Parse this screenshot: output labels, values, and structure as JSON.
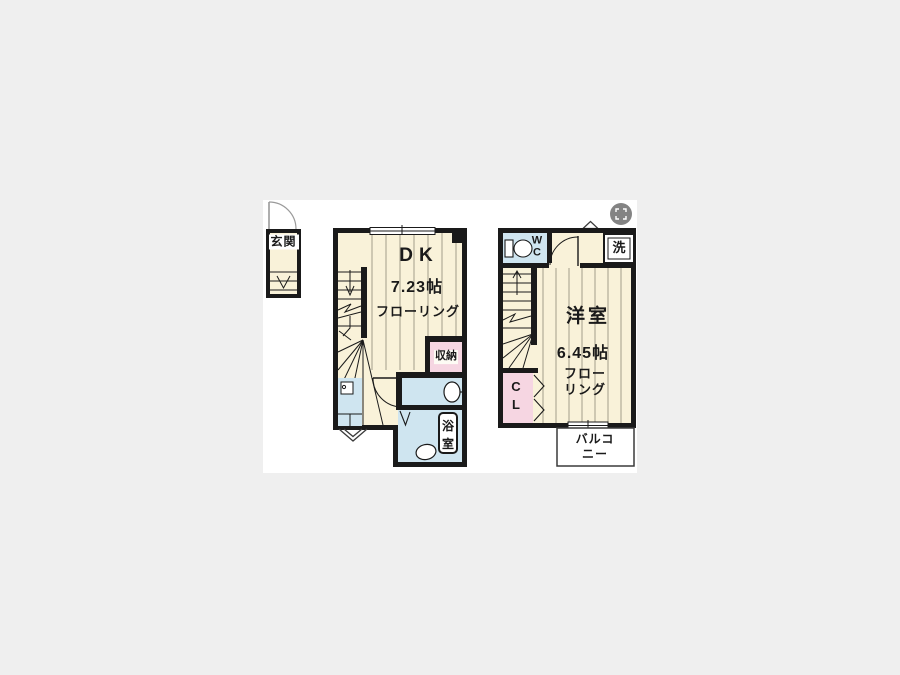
{
  "palette": {
    "background": "#efefef",
    "paper": "#ffffff",
    "wall": "#1a1a1a",
    "floor": "#f9f2d9",
    "wet": "#cfe5f0",
    "closet": "#f6d6e2",
    "floorline": "#a39d8a",
    "thinline": "#3a3a3a",
    "icon_bg": "#6e6e6e"
  },
  "viewer": {
    "expand_icon": "fullscreen-expand"
  },
  "floorplan": {
    "entrance": {
      "label": "玄関"
    },
    "floor1": {
      "room_label": "DK",
      "room_size": "7.23帖",
      "room_floor": "フローリング",
      "storage_label": "収納",
      "bath_label": "浴\n室"
    },
    "floor2": {
      "wc_label": "W\nC",
      "laundry_label": "洗",
      "room_label": "洋室",
      "room_size": "6.45帖",
      "room_floor": "フローリング",
      "closet_label": "C\nL",
      "balcony_label": "バルコニー"
    }
  }
}
